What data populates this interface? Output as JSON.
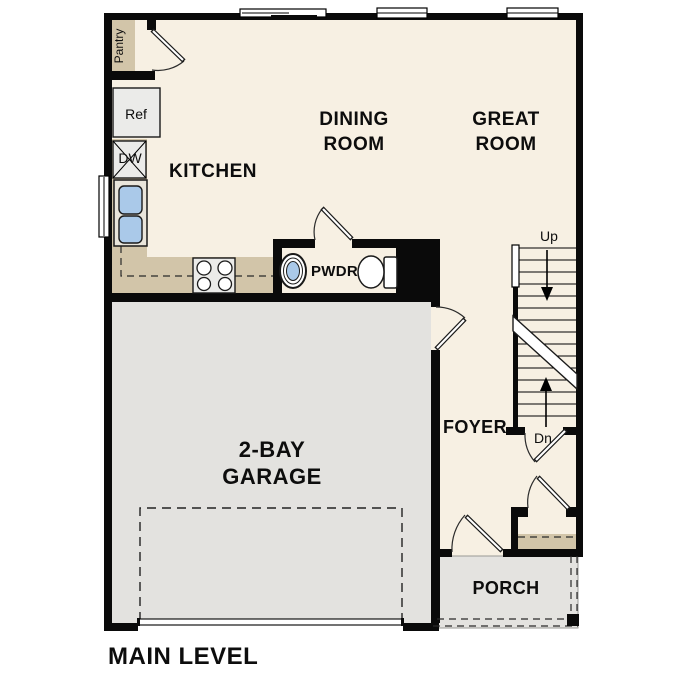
{
  "title": "MAIN LEVEL",
  "rooms": {
    "kitchen": "KITCHEN",
    "dining_line1": "DINING",
    "dining_line2": "ROOM",
    "great_line1": "GREAT",
    "great_line2": "ROOM",
    "garage_line1": "2-BAY",
    "garage_line2": "GARAGE",
    "foyer": "FOYER",
    "porch": "PORCH",
    "powder": "PWDR",
    "pantry": "Pantry"
  },
  "fixtures": {
    "refrigerator": "Ref",
    "dishwasher": "DW"
  },
  "stairs": {
    "up": "Up",
    "down": "Dn"
  },
  "colors": {
    "wall": "#0a0a0a",
    "floor": "#f7f0e3",
    "counter_tan": "#d2c5a9",
    "garage_floor": "#e3e2df",
    "porch_floor": "#e4e3e0",
    "sink_blue": "#aac9e9",
    "appliance_gray": "#ebebe9"
  }
}
